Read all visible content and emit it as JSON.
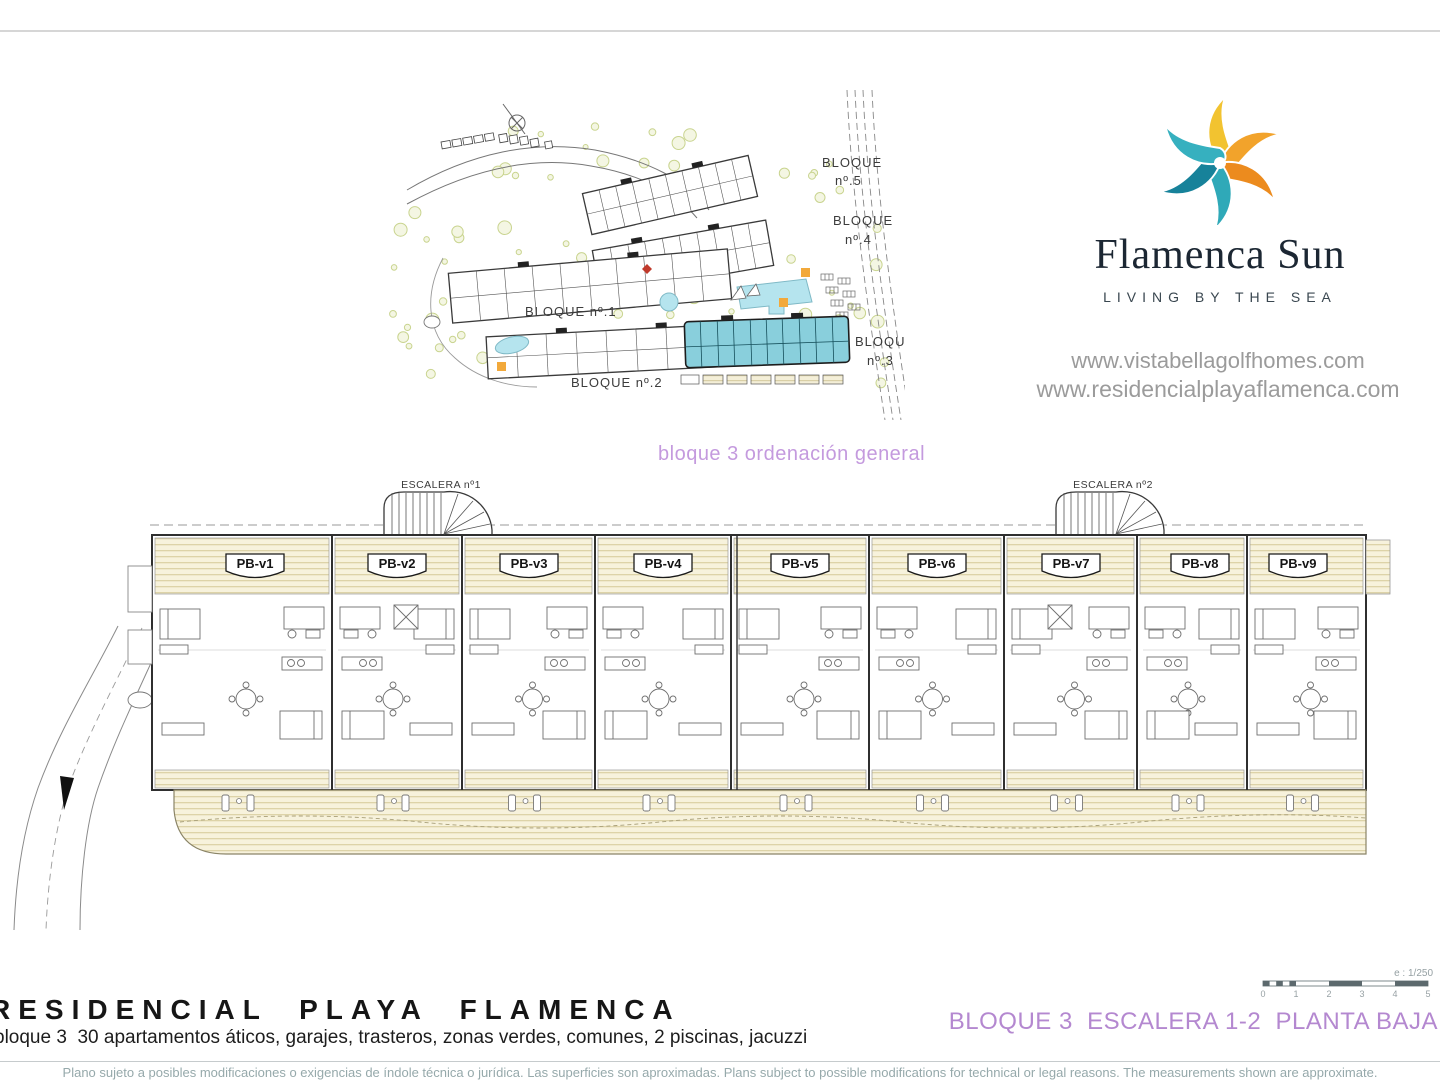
{
  "page": {
    "caption_general": "bloque 3 ordenación general",
    "sheet_title": "BLOQUE 3  ESCALERA 1-2  PLANTA BAJA",
    "project_title": "RESIDENCIAL PLAYA FLAMENCA",
    "project_subtitle": "bloque 3  30 apartamentos áticos, garajes, trasteros, zonas verdes, comunes, 2 piscinas, jacuzzi",
    "disclaimer": "Plano sujeto a posibles modificaciones o exigencias de índole técnica o jurídica. Las superficies son aproximadas. Plans subject to possible modifications for technical or legal reasons. The measurements shown are approximate."
  },
  "brand": {
    "name": "Flamenca Sun",
    "tagline": "LIVING BY THE SEA",
    "url_primary": "www.vistabellagolfhomes.com",
    "url_secondary": "www.residencialplayaflamenca.com",
    "logo_colors": [
      "#F2C330",
      "#F2A32B",
      "#EC8B1E",
      "#2FA9B8",
      "#17829A",
      "#36B0BF"
    ]
  },
  "site_plan": {
    "blocks": [
      {
        "line1": "BLOQUE",
        "line2": "nº.5"
      },
      {
        "line1": "BLOQUE",
        "line2": "nº.4"
      },
      {
        "line1": "BLOQUE nº.1",
        "line2": ""
      },
      {
        "line1": "BLOQUE nº.2",
        "line2": ""
      },
      {
        "line1": "BLOQUE",
        "line2": "nº.3"
      }
    ],
    "highlight_color": "#89cfdc",
    "pool_color": "#b5e4ee",
    "tree_color": "#c9d48f"
  },
  "floor_plan": {
    "stairs": [
      {
        "label": "ESCALERA nº1"
      },
      {
        "label": "ESCALERA nº2"
      }
    ],
    "units": [
      {
        "label": "PB-v1"
      },
      {
        "label": "PB-v2"
      },
      {
        "label": "PB-v3"
      },
      {
        "label": "PB-v4"
      },
      {
        "label": "PB-v5"
      },
      {
        "label": "PB-v6"
      },
      {
        "label": "PB-v7"
      },
      {
        "label": "PB-v8"
      },
      {
        "label": "PB-v9"
      }
    ],
    "deck_color": "#f7f2dc"
  },
  "scale_bar": {
    "label": "e : 1/250",
    "ticks": [
      "0",
      "1",
      "2",
      "3",
      "4",
      "5"
    ]
  },
  "accent_colors": {
    "caption_purple": "#c49ade",
    "sheet_purple": "#b488d0",
    "disclaimer_gray": "#96a9ab"
  }
}
